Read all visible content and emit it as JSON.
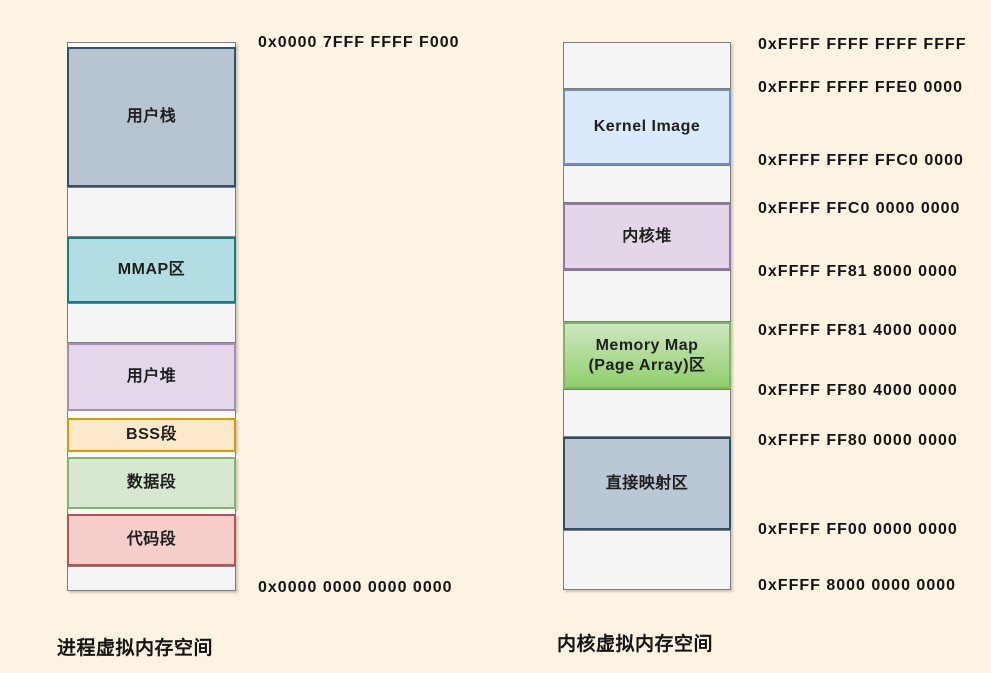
{
  "page": {
    "background": "#fdf3e2",
    "text_color": "#141414"
  },
  "process_space": {
    "title": "进程虚拟内存空间",
    "top_address": "0x0000 7FFF FFFF F000",
    "bottom_address": "0x0000 0000 0000 0000",
    "segments": [
      {
        "name": "user-stack",
        "label": "用户栈",
        "fill": "#b6c5cf",
        "border": "#35506b"
      },
      {
        "name": "mmap-area",
        "label": "MMAP区",
        "fill": "#b2dee3",
        "border": "#117e86"
      },
      {
        "name": "user-heap",
        "label": "用户堆",
        "fill": "#e3d7e9",
        "border": "#a98cba"
      },
      {
        "name": "bss-segment",
        "label": "BSS段",
        "fill": "#ffe9cc",
        "border": "#d79b00"
      },
      {
        "name": "data-segment",
        "label": "数据段",
        "fill": "#d7e8d1",
        "border": "#82b366"
      },
      {
        "name": "code-segment",
        "label": "代码段",
        "fill": "#f8cecc",
        "border": "#b85450"
      }
    ]
  },
  "kernel_space": {
    "title": "内核虚拟内存空间",
    "segments": [
      {
        "name": "kernel-image",
        "label": "Kernel Image",
        "fill": "#dbe9fc",
        "border": "#6c8ebf"
      },
      {
        "name": "kernel-heap",
        "label": "内核堆",
        "fill": "#e2d6e8",
        "border": "#9673a6"
      },
      {
        "name": "memory-map-page-array",
        "label": "Memory Map\n(Page Array)区",
        "fill": "linear-gradient(180deg, #cfe7c0 0%, #90cf6c 100%)",
        "border": "#82b366"
      },
      {
        "name": "direct-map-area",
        "label": "直接映射区",
        "fill": "#bac8d6",
        "border": "#29506e"
      }
    ],
    "addresses": [
      "0xFFFF FFFF FFFF FFFF",
      "0xFFFF FFFF FFE0 0000",
      "0xFFFF FFFF FFC0 0000",
      "0xFFFF FFC0 0000 0000",
      "0xFFFF FF81 8000 0000",
      "0xFFFF FF81 4000 0000",
      "0xFFFF FF80 4000 0000",
      "0xFFFF FF80 0000 0000",
      "0xFFFF FF00 0000 0000",
      "0xFFFF 8000 0000 0000"
    ]
  }
}
